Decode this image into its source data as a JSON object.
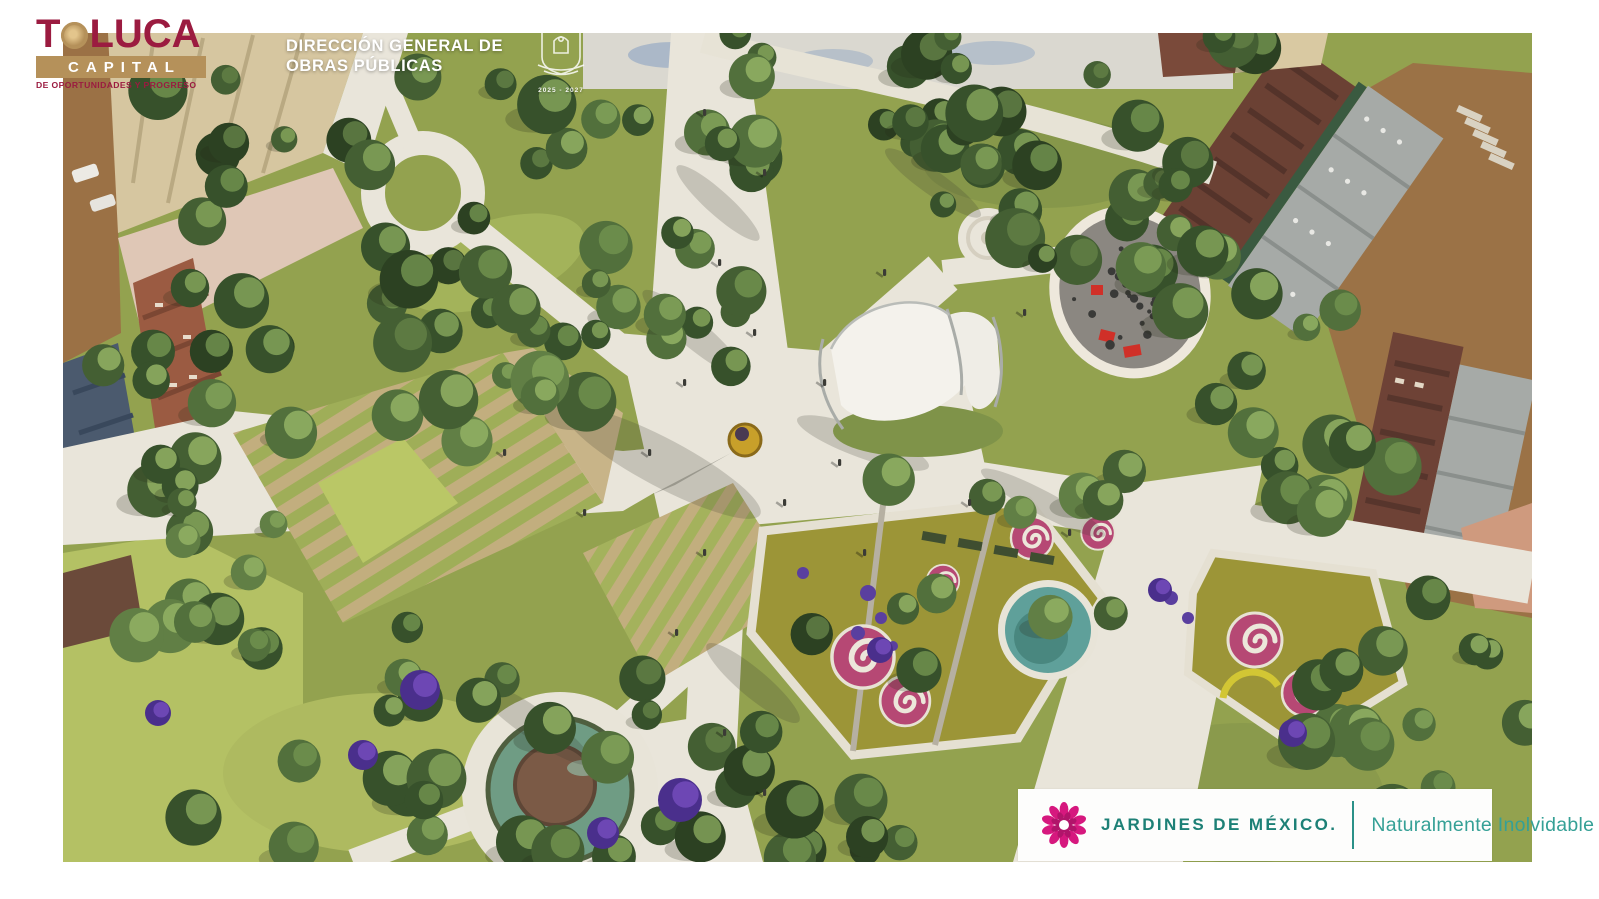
{
  "page": {
    "background": "#ffffff"
  },
  "header": {
    "toluca_logo": {
      "prefix": "T",
      "suffix": "LUCA",
      "capital": "CAPITAL",
      "tagline": "DE OPORTUNIDADES Y PROGRESO",
      "maroon": "#9b1b40",
      "gold": "#b5915a"
    },
    "department": {
      "line1": "DIRECCIÓN GENERAL DE",
      "line2": "OBRAS PÚBLICAS"
    },
    "crest": {
      "icon": "municipal-crest-icon",
      "years": "2025 - 2027"
    }
  },
  "footer": {
    "logo_icon": "dahlia-flower-icon",
    "brand": "JARDINES DE MÉXICO.",
    "slogan": "Naturalmente Inolvidable",
    "magenta": "#d6187e",
    "teal": "#1d8076"
  },
  "scene": {
    "type": "aerial-park-render",
    "features": [
      "central-plaza",
      "monument",
      "bandshell-canopy",
      "playground",
      "round-plaza",
      "terraced-gardens",
      "circular-fountain",
      "flower-spiral-gardens",
      "pond",
      "jacaranda-trees",
      "street-and-buildings"
    ]
  }
}
